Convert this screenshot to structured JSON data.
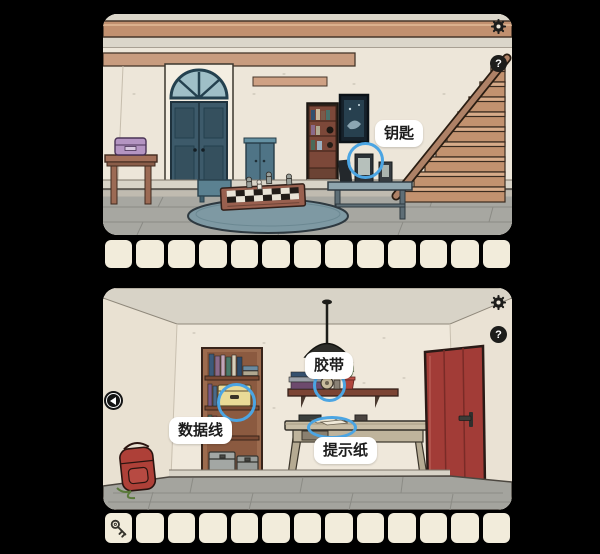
{
  "colors": {
    "background": "#000000",
    "highlight_blue": "#4BA5E3",
    "label_bg": "#FFFFFF",
    "label_text": "#1C1C1C",
    "slot_bg": "#F2ECDB",
    "icon_dark": "#1D1D1B"
  },
  "panels": {
    "top": {
      "help_label": "?",
      "annotations": {
        "key": "钥匙"
      },
      "inventory": {
        "slot_count": 13,
        "items": []
      }
    },
    "bottom": {
      "help_label": "?",
      "annotations": {
        "tape": "胶带",
        "cable": "数据线",
        "paper": "提示纸"
      },
      "inventory": {
        "slot_count": 13,
        "items": [
          {
            "slot": 1,
            "name": "key"
          }
        ]
      }
    }
  }
}
